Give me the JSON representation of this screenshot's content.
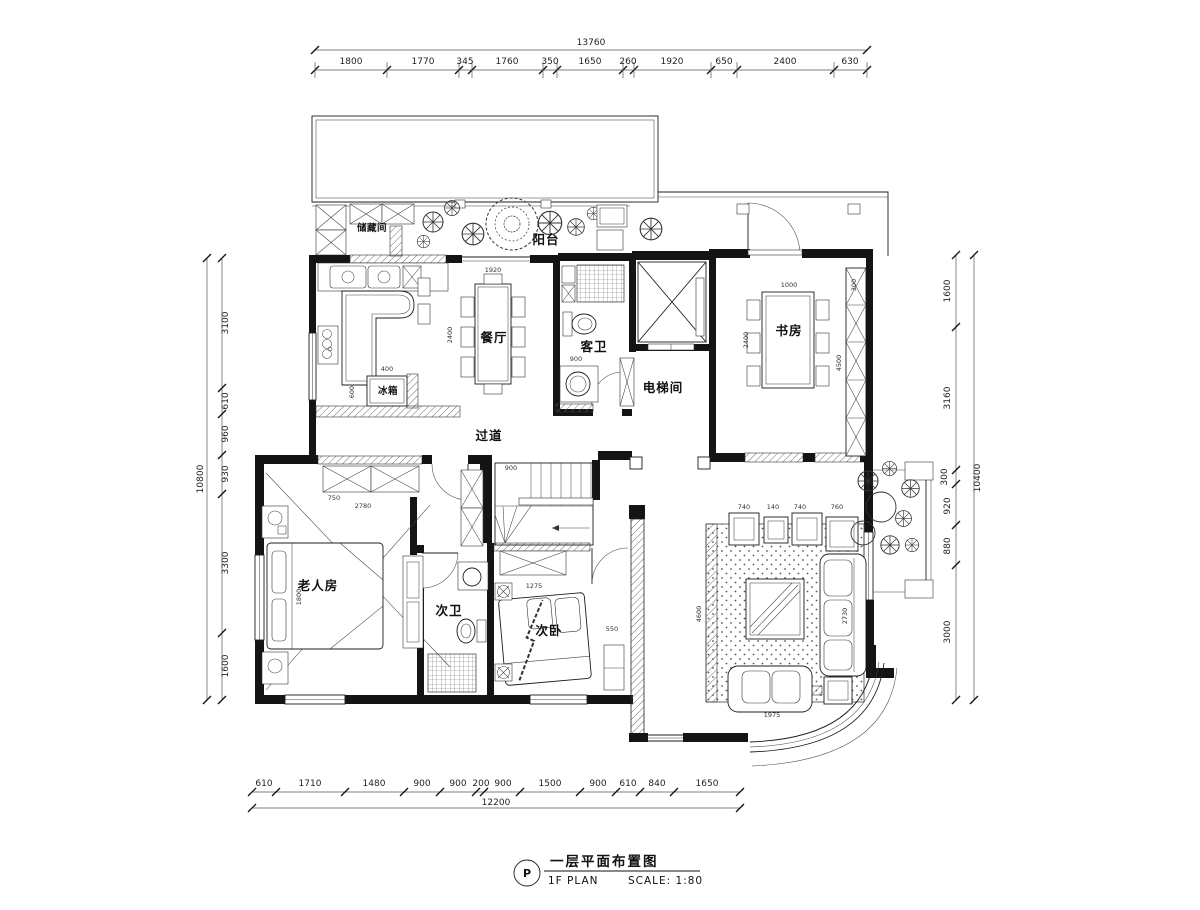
{
  "colors": {
    "line": "#1c1c1c",
    "paper": "#ffffff",
    "hatch": "#6e6e6e"
  },
  "title_block": {
    "symbol": "P",
    "title_cn": "一层平面布置图",
    "title_en": "1F PLAN",
    "scale_label": "SCALE: 1:80"
  },
  "rooms": {
    "storage": "储藏间",
    "balcony": "阳台",
    "dining": "餐厅",
    "guest_bath": "客卫",
    "elevator_hall": "电梯间",
    "study": "书房",
    "corridor": "过道",
    "fridge": "冰箱",
    "elder_room": "老人房",
    "second_bath": "次卫",
    "second_bedroom": "次卧"
  },
  "dims": {
    "top": {
      "total": "13760",
      "segments": [
        "1800",
        "1770",
        "345",
        "1760",
        "350",
        "1650",
        "260",
        "1920",
        "650",
        "2400",
        "630"
      ]
    },
    "bottom": {
      "total": "12200",
      "segments": [
        "610",
        "1710",
        "1480",
        "900",
        "900",
        "200",
        "900",
        "1500",
        "900",
        "610",
        "840",
        "1650"
      ]
    },
    "left": {
      "total": "10800",
      "segments": [
        "3100",
        "610",
        "960",
        "930",
        "3300",
        "1600"
      ]
    },
    "right": {
      "total": "10400",
      "segments": [
        "1600",
        "3160",
        "300",
        "920",
        "880",
        "3000"
      ]
    }
  },
  "furniture_dims": {
    "dining_w": "1920",
    "dining_l": "2400",
    "study_table_w": "1000",
    "study_table_l": "2400",
    "bookshelf_l": "4500",
    "bookshelf_d": "300",
    "armchair_a": "740",
    "armchair_gap": "140",
    "armchair_b": "740",
    "side_table": "760",
    "rug_l": "4600",
    "sofa_l": "2730",
    "loveseat_w": "1975",
    "wardrobe_d": "750",
    "wardrobe_w": "2780",
    "bed_w": "1800",
    "closet_w": "1275",
    "fridge_w": "400",
    "kitchen_d": "600",
    "stair_w": "900",
    "dresser_w": "550",
    "bath_w": "900"
  }
}
